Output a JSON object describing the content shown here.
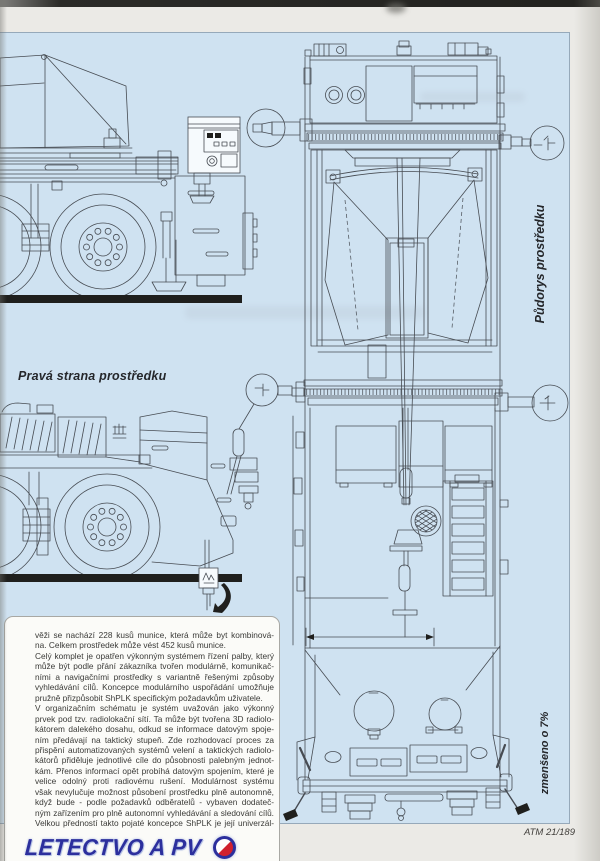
{
  "masthead": {
    "logo_text": "LETECTVO A PV",
    "logo_roundel": "czech-roundel-final-o"
  },
  "figure_labels": {
    "side_view_label": "Pravá strana prostředku",
    "plan_view_label": "Půdorys prostředku",
    "scale_note": "zmenšeno o 7%"
  },
  "footer": {
    "reference": "ATM 21/189"
  },
  "article": {
    "paragraphs": [
      {
        "complete": true,
        "lines": [
          "věži se nachází 228 kusů munice, která může byt kombinová-",
          "na. Celkem prostředek může vést 452 kusů munice."
        ]
      },
      {
        "complete": true,
        "lines": [
          "Celý komplet je opatřen výkonným systémem řízení palby, který",
          "může být podle přání zákazníka tvořen modulárně, komunikač-",
          "ními a navigačními prostředky s variantně řešenými způsoby",
          "vyhledávání cílů. Koncepce modulárního uspořádání umožňuje",
          "pružně přizpůsobit ShPLK specifickým požadavkům uživatele."
        ]
      },
      {
        "complete": false,
        "lines": [
          "V organizačním schématu je systém uvažován jako výkonný",
          "prvek pod tzv. radiolokační sítí. Ta může být tvořena 3D radiolo-",
          "kátorem dalekého dosahu, odkud se informace datovým spoje-",
          "ním předávají na taktický stupeň. Zde rozhodovací proces za",
          "přispění automatizovaných systémů velení a taktických radiolo-",
          "kátorů přiděluje jednotlivé cíle do působnosti palebným jednot-",
          "kám. Přenos informací opět probíhá datovým spojením, které je",
          "velice odolný proti radiovému rušení. Modulárnost systému",
          "však nevylučuje možnost působení prostředku plně autonomně,",
          "když bude - podle požadavků odběratelů - vybaven dodateč-",
          "ným zařízením pro plně autonomní vyhledávání a sledování cílů.",
          "Velkou předností takto pojaté koncepce ShPLK je její univerzál-"
        ]
      }
    ]
  },
  "colors": {
    "panel_blue": "#cfe2f1",
    "page_background": "#ebeae6",
    "drawing_ink": "#474c53",
    "ground_black": "#1f1f1d",
    "logo_blue": "#2c2f9d",
    "roundel_red": "#d0202e"
  }
}
